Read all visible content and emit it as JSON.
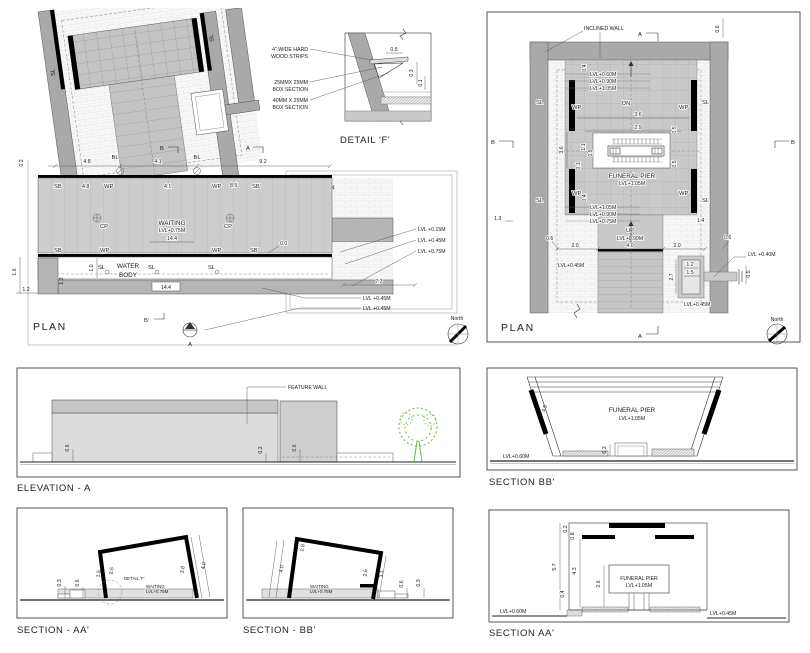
{
  "sheet": {
    "bg": "#ffffff"
  },
  "colors": {
    "wall": "#a9a9a9",
    "floor": "#cacaca",
    "slab": "#b5b5b5",
    "black": "#000000",
    "tree_green": "#76b34e"
  },
  "plan_left": {
    "title": "PLAN",
    "north": "North",
    "marker_b_top": "B",
    "marker_a_top": "A",
    "marker_b_bottom": "B'",
    "marker_a_bottom": "A",
    "dims": {
      "d02": "0.2",
      "d48_top": "4.8",
      "d41_top": "4.1",
      "d92": "9.2",
      "d48": "4.8",
      "d41": "4.1",
      "d85": "8.5",
      "d00": "0.0",
      "d10": "1.0",
      "d16": "1.6",
      "d12a": "1.2",
      "d12b": "1.2",
      "d144_box": "14.4",
      "d144": "14.4",
      "d73": "7.3"
    },
    "labels": {
      "bl1": "BL",
      "bl2": "BL",
      "sl_wall_l": "SL",
      "sl_wall_r": "SL",
      "sb_tl": "SB",
      "wp_t1": "WP",
      "wp_t2": "WP",
      "sb_tr": "SB'",
      "sl_lawn": "SL",
      "lawn": "LAWN",
      "cp1": "CP",
      "cp2": "CP",
      "waiting": "WAITING",
      "waiting_lvl": "LVL+0.75M",
      "sb_bl": "SB",
      "wp_b1": "WP",
      "wp_b2": "WP",
      "sb_br": "SB'",
      "water1": "WATER",
      "water2": "BODY",
      "sl_w1": "SL",
      "sl_w2": "SL",
      "sl_w3": "SL"
    },
    "levels": {
      "l015": "LVL +0.15M",
      "l045a": "LVL +0.45M",
      "l075": "LVL +0.75M",
      "l045b": "LVL +0.45M",
      "l045c": "LVL +0.45M"
    }
  },
  "detail_f": {
    "title": "DETAIL 'F'",
    "note1a": "4\" WIDE HARD",
    "note1b": "WOOD STRIPS",
    "note2a": "25MMX 25MM",
    "note2b": "BOX SECTION",
    "note3a": "40MM X 25MM",
    "note3b": "BOX SECTION",
    "d05": "0.5",
    "d03": "0.3",
    "d01": "0.1"
  },
  "plan_right": {
    "title": "PLAN",
    "north": "North",
    "inclined_wall": "INCLINED WALL",
    "marker_a_top": "A",
    "marker_a_bottom": "A",
    "marker_b_left": "B",
    "marker_b_right": "B",
    "labels": {
      "dn": "DN",
      "up": "UP",
      "up_lvl": "LVL+0.90M",
      "funeral_pier": "FUNERAL PIER",
      "pier_lvl": "LVL+1.05M",
      "sl_tl": "SL",
      "sl_tr": "SL",
      "sl_bl": "SL",
      "sl_br": "SL",
      "wp_tl": "WP",
      "wp_tr": "WP",
      "wp_bl": "WP",
      "wp_br": "WP"
    },
    "levels": {
      "top1": "LVL+0.60M",
      "top2": "LVL+0.90M",
      "top3": "LVL+1.05M",
      "bot1": "LVL+1.05M",
      "bot2": "LVL+0.90M",
      "bot3": "LVL+0.75M",
      "l045l": "LVL+0.45M",
      "l040": "LVL +0.40M",
      "l045r": "LVL+0.45M"
    },
    "dims": {
      "d06tr": "0.6",
      "d04t": "0.4",
      "d36h": "3.6",
      "d29": "2.9",
      "d21": "2.1",
      "d36v": "3.6",
      "d11": "1.1",
      "d09": "0.9",
      "d01": "0.1",
      "d05a": "0.5",
      "d05b": "0.5",
      "d04b": "0.4",
      "d13": "1.3",
      "d06l": "0.6",
      "d06r": "0.6",
      "d20l": "2.0",
      "d40": "4.0",
      "d20r": "2.0",
      "d14": "1.4",
      "d12": "1.2",
      "d15": "1.5",
      "d27": "2.7",
      "d05s": "0.5"
    }
  },
  "elevation_a": {
    "title": "ELEVATION - A",
    "feature_wall": "FEATURE WALL",
    "d06l": "0.6",
    "d03": "0.3",
    "d06r": "0.6"
  },
  "section_bb": {
    "title": "SECTION BB'",
    "funeral_pier": "FUNERAL PIER",
    "pier_lvl": "LVL+1.05M",
    "l060": "LVL+0.60M",
    "d45": "4.5",
    "d03": "0.3"
  },
  "section_aa_small": {
    "title": "SECTION - AA'",
    "detail_f": "DETAIL 'F'",
    "waiting": "WAITING",
    "waiting_lvl": "LVL+0.75M",
    "d03": "0.3",
    "d06": "0.6",
    "d15": "1.5",
    "d26": "2.6",
    "d38": "3.8",
    "d40": "4.0"
  },
  "section_bb_small": {
    "title": "SECTION - BB'",
    "waiting": "WAITING",
    "waiting_lvl": "LVL+0.75M",
    "d40": "4.0",
    "d08": "0.8",
    "d26": "2.6",
    "d31": "3.1",
    "d06": "0.6",
    "d03": "0.3"
  },
  "section_aa": {
    "title": "SECTION AA'",
    "funeral_pier": "FUNERAL PIER",
    "pier_lvl": "LVL+1.05M",
    "l060": "LVL+0.60M",
    "l045": "LVL+0.45M",
    "d02": "0.2",
    "d08": "0.8",
    "d57": "5.7",
    "d43": "4.3",
    "d26": "2.6",
    "d04": "0.4"
  }
}
